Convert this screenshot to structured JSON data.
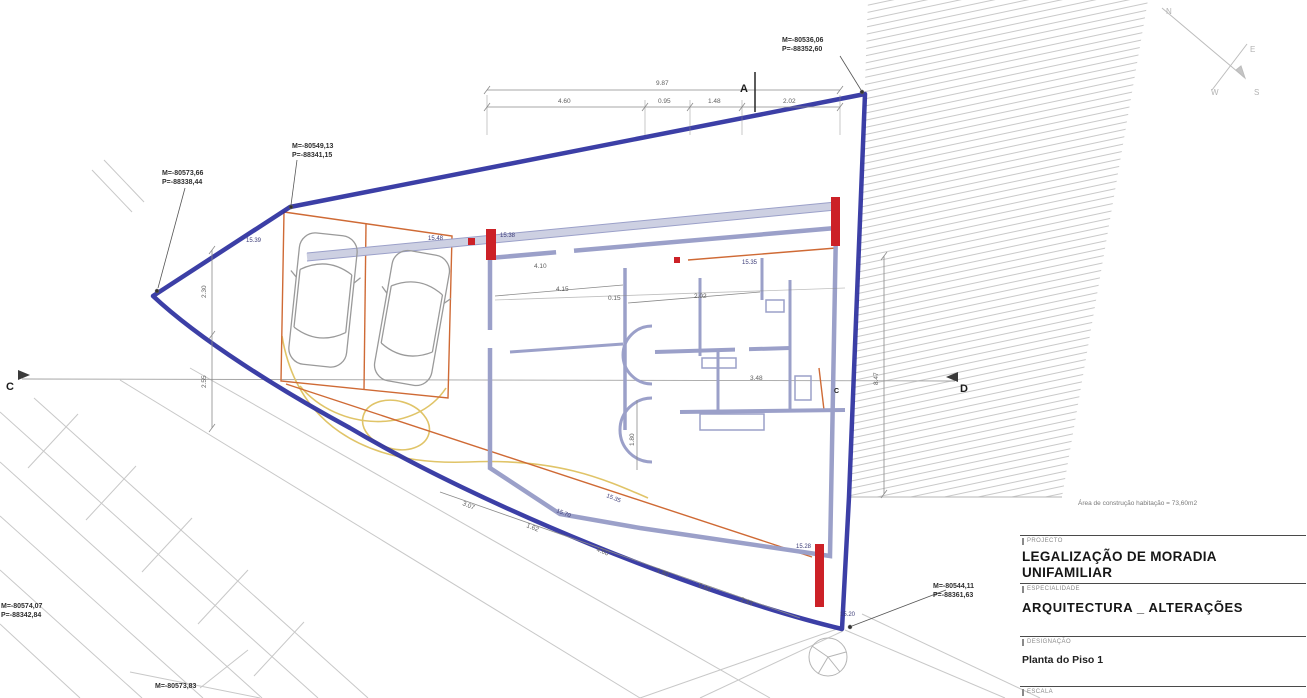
{
  "title_block": {
    "project_label": "PROJECTO",
    "project_line1": "LEGALIZAÇÃO DE MORADIA",
    "project_line2": "UNIFAMILIAR",
    "specialty_label": "ESPECIALIDADE",
    "specialty_value": "ARQUITECTURA _ ALTERAÇÕES",
    "drawing_label": "DESIGNAÇÃO",
    "drawing_value": "Planta do Piso 1",
    "bottom_label": "ESCALA"
  },
  "drawing": {
    "area_note": "Área de construção habitação = 73,60m2",
    "compass": {
      "n": "N",
      "e": "E",
      "s": "S",
      "w": "W"
    },
    "markers": {
      "a": "A",
      "c": "C",
      "d": "D",
      "c_inner": "C"
    },
    "coordinates": {
      "top_right": {
        "m": "M=-80536,06",
        "p": "P=-88352,60"
      },
      "mid_left": {
        "m": "M=-80549,13",
        "p": "P=-88341,15"
      },
      "far_left": {
        "m": "M=-80573,66",
        "p": "P=-88338,44"
      },
      "bottom_right": {
        "m": "M=-80544,11",
        "p": "P=-88361,63"
      },
      "bottom_left": {
        "m": "M=-80574,07",
        "p": "P=-88342,84"
      },
      "bottom_center": {
        "m": "M=-80573,83"
      }
    },
    "dims": {
      "top_total": "9.87",
      "top_segments": [
        "4.60",
        "0.95",
        "1.48",
        "2.02"
      ],
      "right_side": "8.47",
      "left_side": [
        "2.30",
        "2.55"
      ],
      "interior": [
        "4.15",
        "0.15",
        "2.02",
        "3.48",
        "1.80",
        "4.10"
      ],
      "bottom_chain": [
        "3.07",
        "1.62",
        "4.60",
        "1.40",
        "0.60",
        "2.43"
      ]
    },
    "elevations": [
      "15.39",
      "15.48",
      "15.38",
      "15.35",
      "15.70",
      "15.28",
      "15.20",
      "15.35"
    ]
  },
  "colors": {
    "boundary_blue": "#2b2f9e",
    "wall_periwinkle": "#9ba0c9",
    "accent_red": "#cc2127",
    "accent_orange": "#cf6a35",
    "accent_yellow": "#e0c468",
    "line_gray": "#bdbdbd"
  }
}
